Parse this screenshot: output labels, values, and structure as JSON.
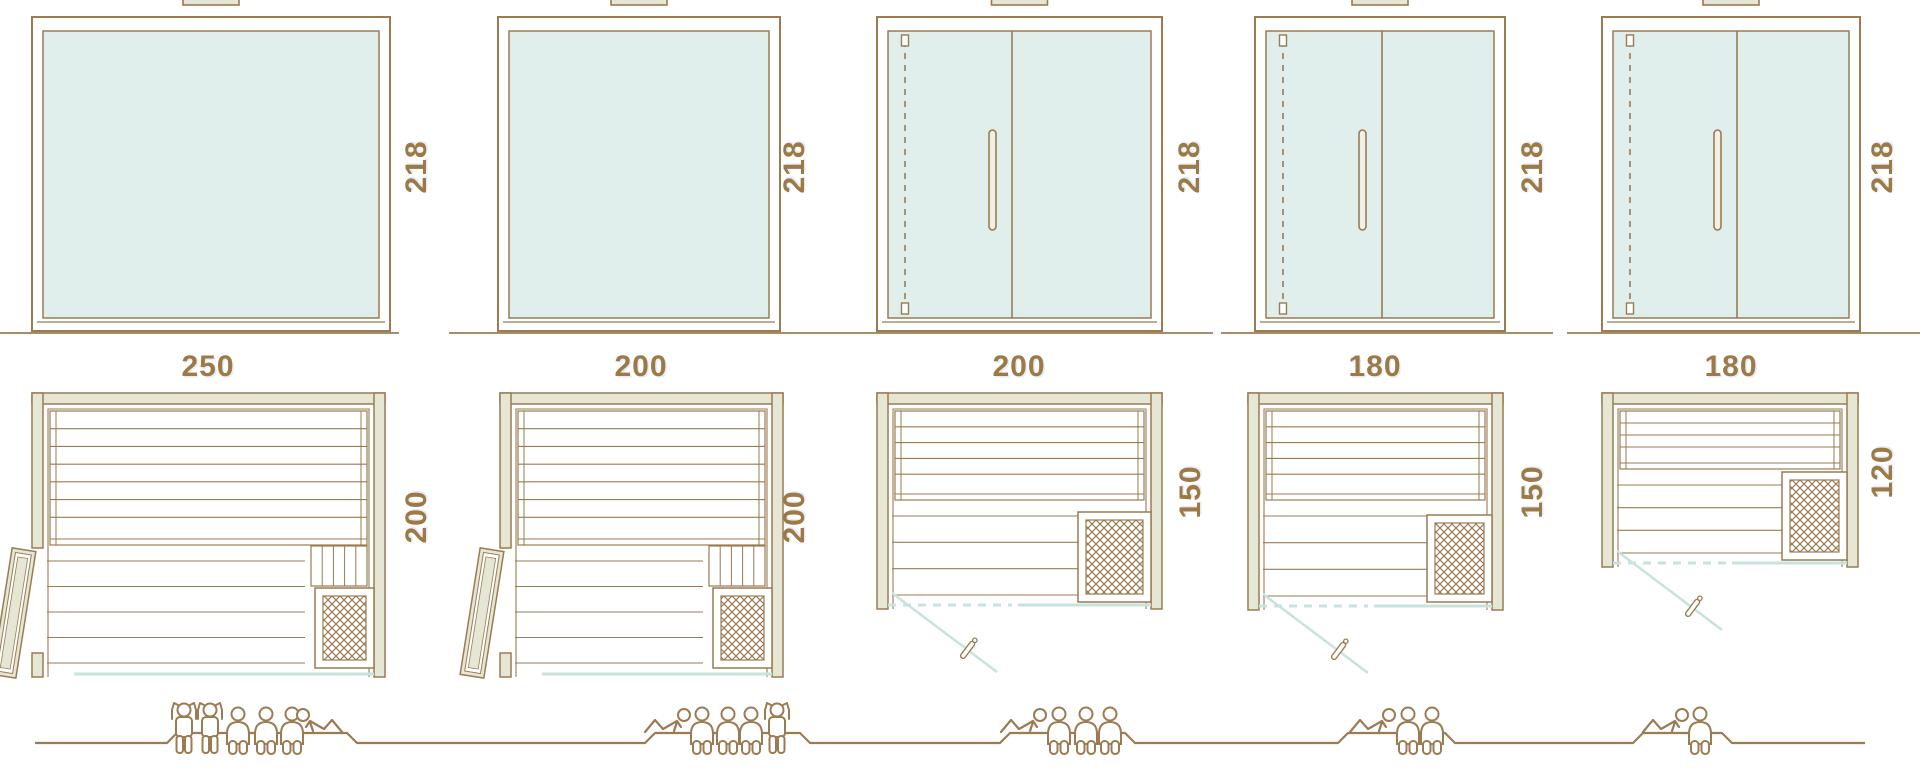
{
  "palette": {
    "line_brown": "#9a7b52",
    "label_brown": "#9d7a45",
    "wood_beige": "#e6e6d4",
    "glass_teal": "#e0efec",
    "teal_line": "#c7e3dd",
    "white": "#ffffff"
  },
  "models": [
    {
      "name": "sauna-250x200",
      "elevation": {
        "height_label": "218",
        "front": "fixed-glass"
      },
      "plan": {
        "width_label": "250",
        "depth_label": "200",
        "door": "hinged door on left side wall, shown open",
        "heater": "bottom-right"
      },
      "capacity": {
        "standing": 2,
        "sitting": 3,
        "lying": 1,
        "figures": [
          "standing",
          "standing",
          "sitting",
          "sitting",
          "sitting",
          "lying"
        ]
      }
    },
    {
      "name": "sauna-200x200",
      "elevation": {
        "height_label": "218",
        "front": "fixed-glass"
      },
      "plan": {
        "width_label": "200",
        "depth_label": "200",
        "door": "hinged door on left side wall, shown open",
        "heater": "bottom-right"
      },
      "capacity": {
        "standing": 1,
        "sitting": 3,
        "lying": 1,
        "figures": [
          "lying",
          "sitting",
          "sitting",
          "sitting",
          "standing"
        ]
      }
    },
    {
      "name": "sauna-200x150",
      "elevation": {
        "height_label": "218",
        "front": "double-glass-door"
      },
      "plan": {
        "width_label": "200",
        "depth_label": "150",
        "door": "front glass door, shown open",
        "heater": "bottom-right"
      },
      "capacity": {
        "standing": 0,
        "sitting": 3,
        "lying": 1,
        "figures": [
          "lying",
          "sitting",
          "sitting",
          "sitting"
        ]
      }
    },
    {
      "name": "sauna-180x150",
      "elevation": {
        "height_label": "218",
        "front": "double-glass-door"
      },
      "plan": {
        "width_label": "180",
        "depth_label": "150",
        "door": "front glass door, shown open",
        "heater": "bottom-right"
      },
      "capacity": {
        "standing": 0,
        "sitting": 2,
        "lying": 1,
        "figures": [
          "lying",
          "sitting",
          "sitting"
        ]
      }
    },
    {
      "name": "sauna-180x120",
      "elevation": {
        "height_label": "218",
        "front": "double-glass-door"
      },
      "plan": {
        "width_label": "180",
        "depth_label": "120",
        "door": "front glass door, shown open",
        "heater": "middle-right"
      },
      "capacity": {
        "standing": 0,
        "sitting": 1,
        "lying": 1,
        "figures": [
          "lying",
          "sitting"
        ]
      }
    }
  ]
}
